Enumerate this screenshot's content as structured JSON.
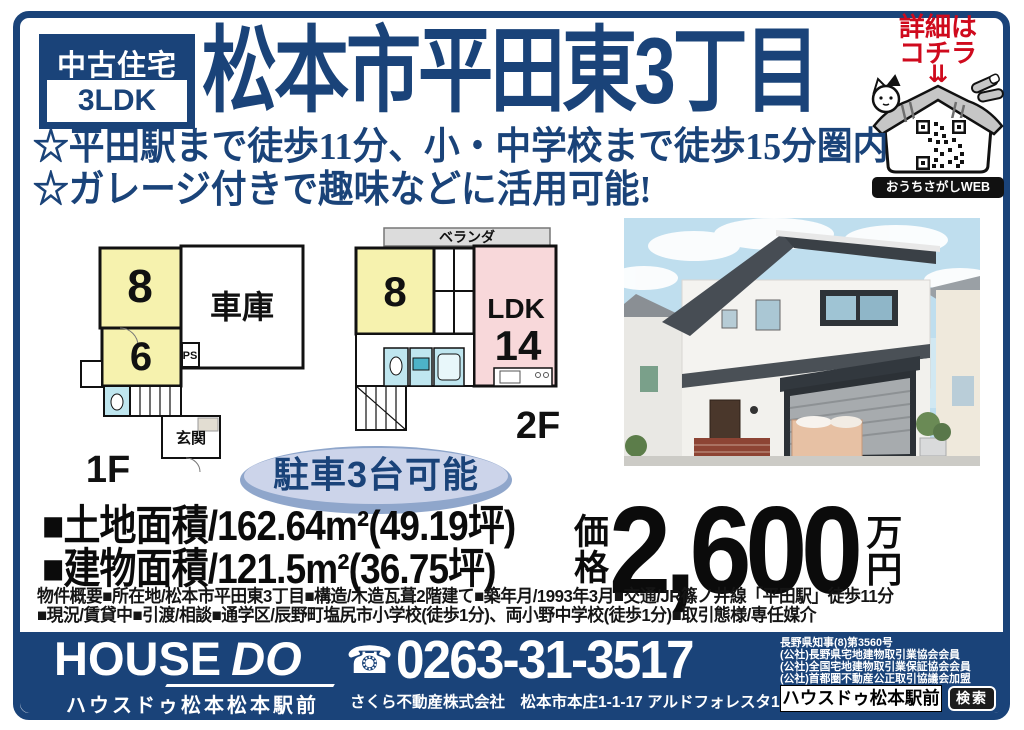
{
  "colors": {
    "navy": "#1a4379",
    "red": "#cf0a1d",
    "room_yellow": "#f6f2ae",
    "room_pink": "#f8d8da",
    "room_blue": "#bfe6ef"
  },
  "badge": {
    "top": "中古住宅",
    "bottom": "3LDK"
  },
  "title": "松本市平田東3丁目",
  "cta": {
    "line1": "詳細は",
    "line2": "コチラ",
    "arrow": "⇊",
    "web_label": "おうちさがしWEB"
  },
  "highlights": {
    "line1": "☆平田駅まで徒歩11分、小・中学校まで徒歩15分圏内",
    "line2": "☆ガレージ付きで趣味などに活用可能!"
  },
  "floorplan1f": {
    "floor_label": "1F",
    "room8": "8",
    "room6": "6",
    "garage": "車庫",
    "ps": "PS",
    "entrance": "玄関"
  },
  "floorplan2f": {
    "floor_label": "2F",
    "veranda": "ベランダ",
    "room8": "8",
    "ldk": "LDK",
    "ldk_size": "14"
  },
  "parking": "駐車3台可能",
  "area": {
    "land": "■土地面積/162.64m²(49.19坪)",
    "building": "■建物面積/121.5m²(36.75坪)"
  },
  "price": {
    "label1": "価",
    "label2": "格",
    "amount": "2,600",
    "unit1": "万",
    "unit2": "円"
  },
  "overview": {
    "line1": "物件概要■所在地/松本市平田東3丁目■構造/木造瓦葺2階建て■築年月/1993年3月■交通/JR篠ノ井線「平田駅」徒歩11分",
    "line2": "■現況/賃貸中■引渡/相談■通学区/辰野町塩尻市小学校(徒歩1分)、両小野中学校(徒歩1分)■取引態様/専任媒介"
  },
  "footer": {
    "logo1": "HOUSE",
    "logo2": "DO",
    "store": "ハウスドゥ松本松本駅前",
    "tel_icon": "☎",
    "tel": "0263-31-3517",
    "company": "さくら不動産株式会社　松本市本庄1-1-17 アルドフォレスタ1F",
    "licenses": [
      "長野県知事(8)第3560号",
      "(公社)長野県宅地建物取引業協会会員",
      "(公社)全国宅地建物取引業保証協会会員",
      "(公社)首都圏不動産公正取引協議会加盟"
    ],
    "search_text": "ハウスドゥ松本駅前",
    "search_button": "検索"
  }
}
